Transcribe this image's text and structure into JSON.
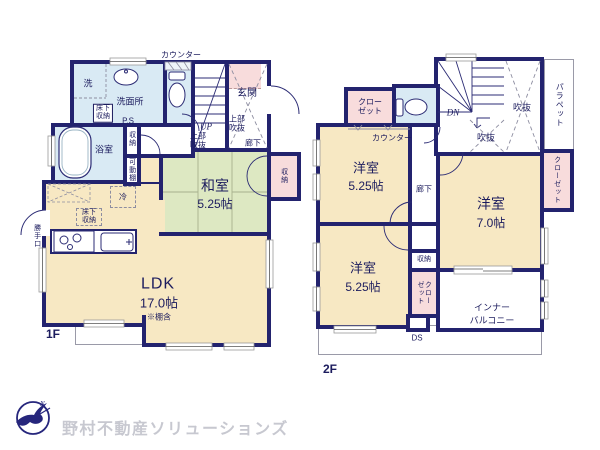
{
  "colors": {
    "wall": "#23236e",
    "room_cream": "#f7e8c3",
    "tatami_green": "#dde8c2",
    "water_blue": "#d9eaf4",
    "closet_pink": "#f8dcdc",
    "text_navy": "#1c1c5e",
    "logo_gray": "#c7c8d0",
    "bird_navy": "#26267c"
  },
  "floor1": {
    "floor_label": "1F",
    "labels": {
      "counter": "カウンター",
      "laundry": "洗",
      "washroom": "洗面所",
      "underfloor_box": "床下収納",
      "ps": "P.S",
      "bathroom": "浴室",
      "hall_storage": "収納",
      "movable_shelf": "可動棚",
      "entrance": "玄関",
      "entrance_upper_void": "上部吹抜",
      "corridor": "廊下",
      "up": "UP",
      "stairs_upper_void": "上部吹抜",
      "washitsu": "和室",
      "washitsu_size": "5.25帖",
      "washitsu_storage": "収納",
      "fridge": "冷",
      "kitchen_underfloor": "床下収納",
      "back_door": "勝手口",
      "ldk": "LDK",
      "ldk_size": "17.0帖",
      "ldk_note": "※棚含"
    }
  },
  "floor2": {
    "floor_label": "2F",
    "labels": {
      "closet_nw": "クローゼット",
      "counter": "カウンター",
      "dn": "DN",
      "void_large": "吹抜",
      "void_small": "吹抜",
      "parapet": "パラペット",
      "room_a": "洋室",
      "room_a_size": "5.25帖",
      "corridor": "廊下",
      "room_b": "洋室",
      "room_b_size": "7.0帖",
      "closet_e": "クローゼット",
      "room_c": "洋室",
      "room_c_size": "5.25帖",
      "storage": "収納",
      "closet_s": "クローゼット",
      "balcony_l1": "インナー",
      "balcony_l2": "バルコニー",
      "ds": "DS"
    }
  },
  "logo": {
    "company": "野村不動産ソリューションズ"
  }
}
